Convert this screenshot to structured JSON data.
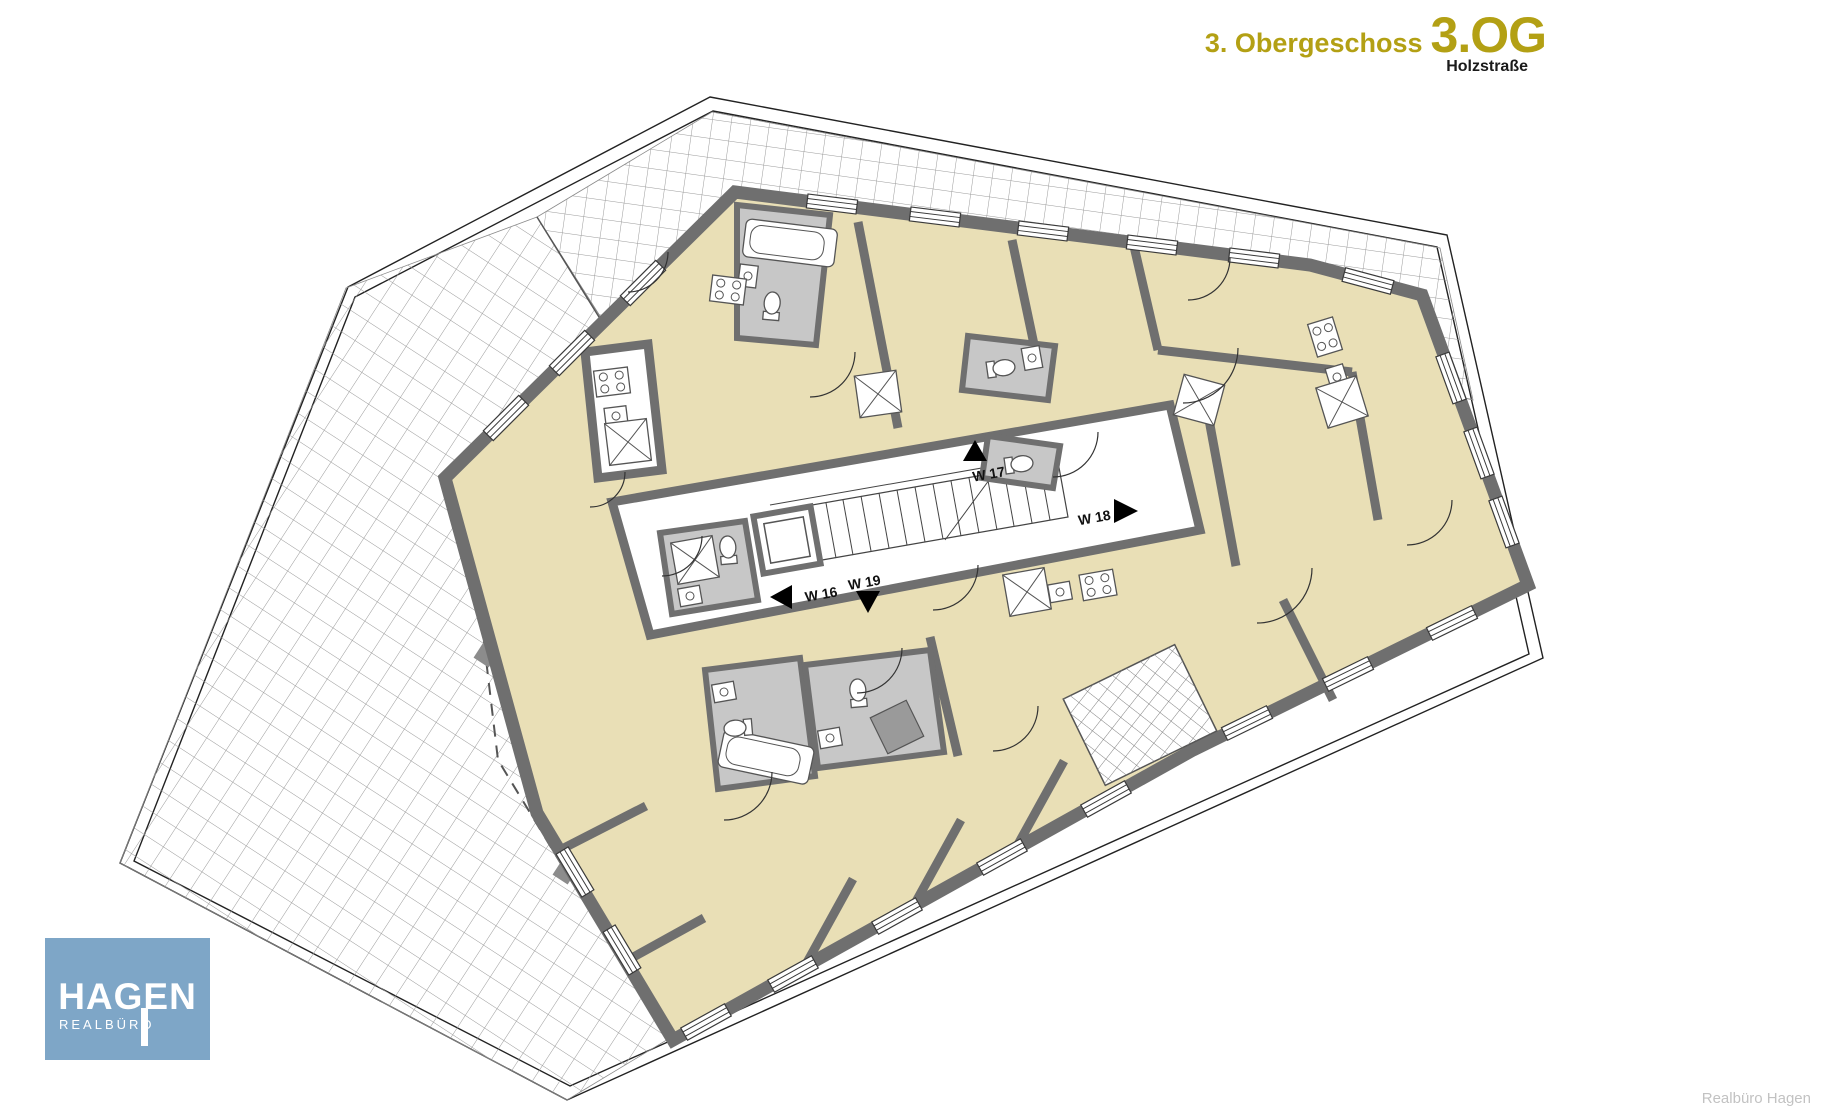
{
  "header": {
    "floor_name": "3. Obergeschoss",
    "floor_code": "3.OG",
    "street": "Holzstraße",
    "accent_color": "#b3a014"
  },
  "plan": {
    "apartments": [
      {
        "label": "W 16",
        "arrow": "left"
      },
      {
        "label": "W 17",
        "arrow": "up"
      },
      {
        "label": "W 18",
        "arrow": "right"
      },
      {
        "label": "W 19",
        "arrow": "down"
      }
    ],
    "colors": {
      "apartment_fill": "#e9dfb6",
      "wall": "#6f6f6f",
      "bathroom_fill": "#c7c7c7",
      "terrace_grid_line": "#8a8a8a",
      "stairwell_fill": "#ffffff"
    }
  },
  "logo": {
    "brand": "HAGEN",
    "subtitle": "REALBÜRO",
    "background_color": "#7ea6c7",
    "text_color": "#ffffff"
  },
  "credit": "Realbüro Hagen"
}
